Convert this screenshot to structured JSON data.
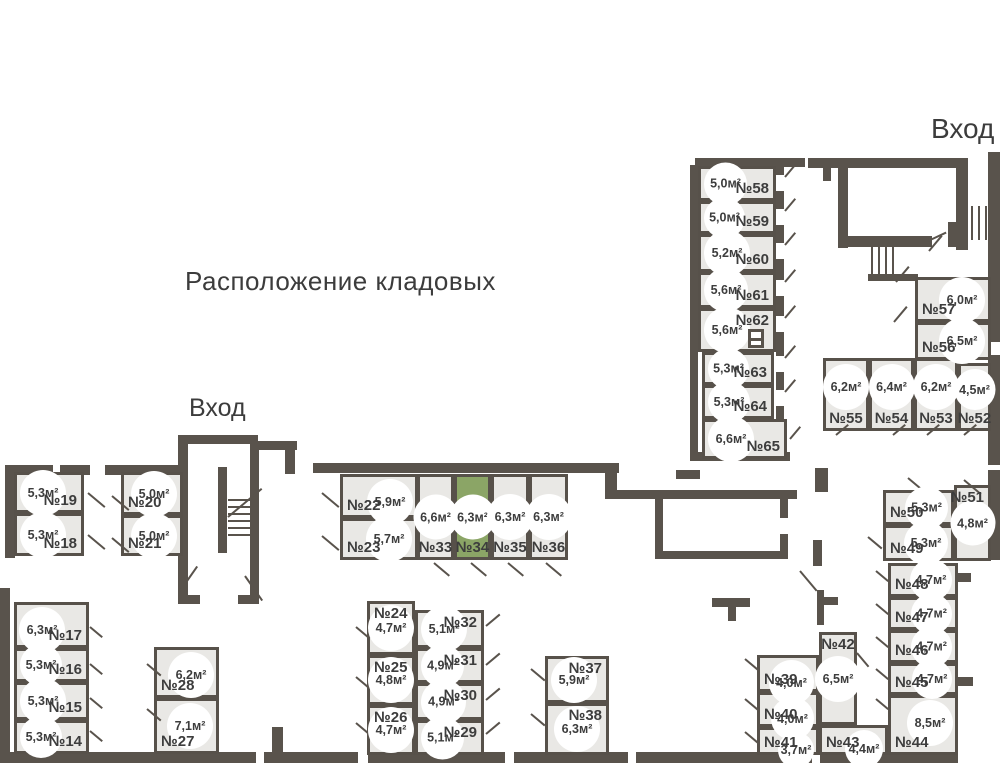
{
  "title": "Расположение кладовых",
  "entrances": {
    "top": {
      "label": "Вход"
    },
    "left": {
      "label": "Вход"
    }
  },
  "colors": {
    "wall": "#59534c",
    "room_fill": "#e9e8e5",
    "room_border": "#57514a",
    "highlight": "#8ba566",
    "text": "#3d3d3d",
    "white": "#ffffff"
  },
  "rooms": [
    {
      "n": "№19",
      "a": "5,3м²",
      "x": 14,
      "y": 472,
      "w": 70,
      "h": 41,
      "np": "br",
      "ap": "l"
    },
    {
      "n": "№18",
      "a": "5,3м²",
      "x": 14,
      "y": 513,
      "w": 70,
      "h": 43,
      "np": "br",
      "ap": "l"
    },
    {
      "n": "№20",
      "a": "5,0м²",
      "x": 121,
      "y": 472,
      "w": 62,
      "h": 43,
      "np": "bl",
      "ap": "r"
    },
    {
      "n": "№21",
      "a": "5,0м²",
      "x": 121,
      "y": 515,
      "w": 62,
      "h": 41,
      "np": "bl",
      "ap": "r"
    },
    {
      "n": "№22",
      "a": "5,9м²",
      "x": 340,
      "y": 474,
      "w": 78,
      "h": 44,
      "np": "bl",
      "ap": "tr"
    },
    {
      "n": "№23",
      "a": "5,7м²",
      "x": 340,
      "y": 518,
      "w": 78,
      "h": 42,
      "np": "bl",
      "ap": "r"
    },
    {
      "n": "№33",
      "a": "6,6м²",
      "x": 417,
      "y": 474,
      "w": 37,
      "h": 86,
      "np": "b",
      "ap": "c"
    },
    {
      "n": "№34",
      "a": "6,3м²",
      "x": 454,
      "y": 474,
      "w": 37,
      "h": 86,
      "np": "b",
      "ap": "c",
      "hl": true
    },
    {
      "n": "№35",
      "a": "6,3м²",
      "x": 491,
      "y": 474,
      "w": 38,
      "h": 86,
      "np": "b",
      "ap": "c"
    },
    {
      "n": "№36",
      "a": "6,3м²",
      "x": 529,
      "y": 474,
      "w": 39,
      "h": 86,
      "np": "b",
      "ap": "c"
    },
    {
      "n": "№17",
      "a": "6,3м²",
      "x": 14,
      "y": 602,
      "w": 75,
      "h": 46,
      "np": "br",
      "ap": "tl"
    },
    {
      "n": "№16",
      "a": "5,3м²",
      "x": 14,
      "y": 648,
      "w": 75,
      "h": 34,
      "np": "br",
      "ap": "l"
    },
    {
      "n": "№15",
      "a": "5,3м²",
      "x": 14,
      "y": 682,
      "w": 75,
      "h": 38,
      "np": "br",
      "ap": "l"
    },
    {
      "n": "№14",
      "a": "5,3м²",
      "x": 14,
      "y": 720,
      "w": 75,
      "h": 34,
      "np": "br",
      "ap": "l"
    },
    {
      "n": "№28",
      "a": "6,2м²",
      "x": 154,
      "y": 647,
      "w": 65,
      "h": 51,
      "np": "bl",
      "ap": "tr"
    },
    {
      "n": "№27",
      "a": "7,1м²",
      "x": 154,
      "y": 698,
      "w": 65,
      "h": 56,
      "np": "bl",
      "ap": "r"
    },
    {
      "n": "№24",
      "a": "4,7м²",
      "x": 367,
      "y": 601,
      "w": 48,
      "h": 54,
      "np": "tl",
      "ap": "c"
    },
    {
      "n": "№25",
      "a": "4,8м²",
      "x": 367,
      "y": 655,
      "w": 48,
      "h": 50,
      "np": "tl",
      "ap": "c"
    },
    {
      "n": "№26",
      "a": "4,7м²",
      "x": 367,
      "y": 705,
      "w": 48,
      "h": 50,
      "np": "tl",
      "ap": "c"
    },
    {
      "n": "№32",
      "a": "5,1м²",
      "x": 415,
      "y": 610,
      "w": 69,
      "h": 38,
      "np": "tr",
      "ap": "l"
    },
    {
      "n": "№31",
      "a": "4,9м²",
      "x": 415,
      "y": 648,
      "w": 69,
      "h": 35,
      "np": "tr",
      "ap": "l"
    },
    {
      "n": "№30",
      "a": "4,9м²",
      "x": 415,
      "y": 683,
      "w": 69,
      "h": 37,
      "np": "tr",
      "ap": "l"
    },
    {
      "n": "№29",
      "a": "5,1м²",
      "x": 415,
      "y": 720,
      "w": 69,
      "h": 35,
      "np": "tr",
      "ap": "l"
    },
    {
      "n": "№37",
      "a": "5,9м²",
      "x": 545,
      "y": 656,
      "w": 64,
      "h": 47,
      "np": "tr",
      "ap": "l"
    },
    {
      "n": "№38",
      "a": "6,3м²",
      "x": 545,
      "y": 703,
      "w": 64,
      "h": 52,
      "np": "tr",
      "ap": "c"
    },
    {
      "n": "№39",
      "a": "4,0м²",
      "x": 757,
      "y": 655,
      "w": 62,
      "h": 37,
      "np": "bl",
      "ap": "tr"
    },
    {
      "n": "№40",
      "a": "4,0м²",
      "x": 757,
      "y": 692,
      "w": 62,
      "h": 35,
      "np": "bl",
      "ap": "tr"
    },
    {
      "n": "№41",
      "a": "3,7м²",
      "x": 757,
      "y": 727,
      "w": 62,
      "h": 28,
      "np": "bl",
      "ap": "tr"
    },
    {
      "n": "№42",
      "a": "6,5м²",
      "x": 819,
      "y": 632,
      "w": 38,
      "h": 93,
      "np": "t",
      "ap": "c"
    },
    {
      "n": "№43",
      "a": "4,4м²",
      "x": 819,
      "y": 725,
      "w": 69,
      "h": 30,
      "np": "bl",
      "ap": "tr"
    },
    {
      "n": "№44",
      "a": "8,5м²",
      "x": 888,
      "y": 695,
      "w": 70,
      "h": 60,
      "np": "bl",
      "ap": "tr"
    },
    {
      "n": "№45",
      "a": "4,7м²",
      "x": 888,
      "y": 663,
      "w": 70,
      "h": 32,
      "np": "bl",
      "ap": "r"
    },
    {
      "n": "№46",
      "a": "4,7м²",
      "x": 888,
      "y": 630,
      "w": 70,
      "h": 33,
      "np": "bl",
      "ap": "r"
    },
    {
      "n": "№47",
      "a": "4,7м²",
      "x": 888,
      "y": 597,
      "w": 70,
      "h": 33,
      "np": "bl",
      "ap": "r"
    },
    {
      "n": "№48",
      "a": "4,7м²",
      "x": 888,
      "y": 563,
      "w": 70,
      "h": 34,
      "np": "bl",
      "ap": "r"
    },
    {
      "n": "№49",
      "a": "5,3м²",
      "x": 883,
      "y": 525,
      "w": 71,
      "h": 36,
      "np": "bl",
      "ap": "r"
    },
    {
      "n": "№50",
      "a": "5,3м²",
      "x": 883,
      "y": 490,
      "w": 71,
      "h": 35,
      "np": "bl",
      "ap": "r"
    },
    {
      "n": "№51",
      "a": "4,8м²",
      "x": 954,
      "y": 485,
      "w": 37,
      "h": 76,
      "np": "tr",
      "ap": "c"
    },
    {
      "n": "№55",
      "a": "6,2м²",
      "x": 823,
      "y": 358,
      "w": 46,
      "h": 73,
      "np": "b",
      "ap": "t"
    },
    {
      "n": "№54",
      "a": "6,4м²",
      "x": 869,
      "y": 358,
      "w": 45,
      "h": 73,
      "np": "b",
      "ap": "t"
    },
    {
      "n": "№53",
      "a": "6,2м²",
      "x": 914,
      "y": 358,
      "w": 44,
      "h": 73,
      "np": "b",
      "ap": "t"
    },
    {
      "n": "№52",
      "a": "4,5м²",
      "x": 958,
      "y": 363,
      "w": 33,
      "h": 68,
      "np": "b",
      "ap": "t"
    },
    {
      "n": "№57",
      "a": "6,0м²",
      "x": 915,
      "y": 277,
      "w": 76,
      "h": 45,
      "np": "bl",
      "ap": "r"
    },
    {
      "n": "№56",
      "a": "6,5м²",
      "x": 915,
      "y": 322,
      "w": 76,
      "h": 38,
      "np": "bl",
      "ap": "r"
    },
    {
      "n": "№58",
      "a": "5,0м²",
      "x": 698,
      "y": 166,
      "w": 78,
      "h": 35,
      "np": "br",
      "ap": "l"
    },
    {
      "n": "№59",
      "a": "5,0м²",
      "x": 698,
      "y": 201,
      "w": 78,
      "h": 33,
      "np": "br",
      "ap": "l"
    },
    {
      "n": "№60",
      "a": "5,2м²",
      "x": 698,
      "y": 234,
      "w": 78,
      "h": 38,
      "np": "br",
      "ap": "l"
    },
    {
      "n": "№61",
      "a": "5,6м²",
      "x": 698,
      "y": 272,
      "w": 78,
      "h": 36,
      "np": "br",
      "ap": "l"
    },
    {
      "n": "№62",
      "a": "5,6м²",
      "x": 698,
      "y": 308,
      "w": 78,
      "h": 44,
      "np": "tr",
      "ap": "l"
    },
    {
      "n": "№63",
      "a": "5,3м²",
      "x": 702,
      "y": 352,
      "w": 72,
      "h": 33,
      "np": "br",
      "ap": "l"
    },
    {
      "n": "№64",
      "a": "5,3м²",
      "x": 702,
      "y": 385,
      "w": 72,
      "h": 34,
      "np": "br",
      "ap": "l"
    },
    {
      "n": "№65",
      "a": "6,6м²",
      "x": 702,
      "y": 419,
      "w": 85,
      "h": 40,
      "np": "br",
      "ap": "l"
    }
  ],
  "walls": [
    [
      695,
      158,
      110,
      9
    ],
    [
      808,
      158,
      160,
      10
    ],
    [
      988,
      152,
      12,
      190
    ],
    [
      690,
      165,
      8,
      296
    ],
    [
      776,
      165,
      8,
      292
    ],
    [
      776,
      175,
      8,
      16,
      "#ffffff"
    ],
    [
      776,
      209,
      8,
      16,
      "#ffffff"
    ],
    [
      776,
      243,
      8,
      16,
      "#ffffff"
    ],
    [
      776,
      280,
      8,
      16,
      "#ffffff"
    ],
    [
      776,
      316,
      8,
      16,
      "#ffffff"
    ],
    [
      776,
      356,
      8,
      16,
      "#ffffff"
    ],
    [
      776,
      390,
      8,
      16,
      "#ffffff"
    ],
    [
      823,
      167,
      8,
      14
    ],
    [
      838,
      168,
      10,
      80
    ],
    [
      956,
      168,
      12,
      82
    ],
    [
      838,
      236,
      94,
      11
    ],
    [
      948,
      222,
      10,
      25
    ],
    [
      868,
      274,
      50,
      7
    ],
    [
      988,
      355,
      12,
      110
    ],
    [
      988,
      470,
      12,
      90
    ],
    [
      698,
      452,
      92,
      9
    ],
    [
      676,
      470,
      24,
      9
    ],
    [
      605,
      463,
      12,
      35
    ],
    [
      573,
      463,
      46,
      10
    ],
    [
      313,
      463,
      262,
      10
    ],
    [
      105,
      465,
      80,
      10
    ],
    [
      5,
      465,
      48,
      10
    ],
    [
      60,
      465,
      30,
      10
    ],
    [
      5,
      470,
      10,
      88
    ],
    [
      178,
      435,
      80,
      9
    ],
    [
      178,
      443,
      10,
      160
    ],
    [
      250,
      443,
      9,
      160
    ],
    [
      257,
      441,
      40,
      9
    ],
    [
      285,
      450,
      10,
      24
    ],
    [
      218,
      467,
      9,
      86
    ],
    [
      178,
      595,
      22,
      9
    ],
    [
      238,
      595,
      21,
      9
    ],
    [
      605,
      490,
      192,
      9
    ],
    [
      655,
      497,
      8,
      62
    ],
    [
      655,
      551,
      132,
      8
    ],
    [
      780,
      492,
      8,
      26
    ],
    [
      780,
      534,
      8,
      25
    ],
    [
      815,
      468,
      13,
      24
    ],
    [
      813,
      540,
      9,
      26
    ],
    [
      817,
      590,
      7,
      35
    ],
    [
      822,
      597,
      16,
      8
    ],
    [
      712,
      598,
      38,
      9
    ],
    [
      728,
      607,
      8,
      14
    ],
    [
      0,
      588,
      10,
      175
    ],
    [
      272,
      727,
      11,
      26
    ],
    [
      954,
      573,
      17,
      9
    ],
    [
      954,
      677,
      19,
      9
    ],
    [
      5,
      752,
      953,
      11
    ],
    [
      256,
      752,
      8,
      11,
      "#ffffff"
    ],
    [
      358,
      752,
      10,
      11,
      "#ffffff"
    ],
    [
      505,
      752,
      9,
      11,
      "#ffffff"
    ],
    [
      628,
      752,
      8,
      11,
      "#ffffff"
    ],
    [
      812,
      752,
      8,
      11,
      "#ffffff"
    ]
  ],
  "stairs": [
    [
      964,
      206,
      24,
      34,
      "v"
    ],
    [
      871,
      243,
      27,
      33,
      "v"
    ],
    [
      228,
      499,
      22,
      40,
      "h"
    ]
  ],
  "doors": [
    [
      88,
      492,
      22,
      40
    ],
    [
      112,
      495,
      22,
      40
    ],
    [
      88,
      534,
      22,
      40
    ],
    [
      112,
      537,
      22,
      40
    ],
    [
      322,
      492,
      22,
      40
    ],
    [
      322,
      535,
      22,
      40
    ],
    [
      434,
      562,
      20,
      40
    ],
    [
      471,
      562,
      20,
      40
    ],
    [
      508,
      562,
      20,
      40
    ],
    [
      546,
      562,
      20,
      40
    ],
    [
      180,
      590,
      30,
      -55
    ],
    [
      245,
      575,
      30,
      55
    ],
    [
      90,
      626,
      16,
      40
    ],
    [
      90,
      663,
      16,
      40
    ],
    [
      90,
      697,
      16,
      40
    ],
    [
      90,
      730,
      16,
      40
    ],
    [
      147,
      663,
      18,
      40
    ],
    [
      147,
      708,
      18,
      40
    ],
    [
      356,
      626,
      18,
      40
    ],
    [
      356,
      676,
      18,
      40
    ],
    [
      356,
      722,
      18,
      40
    ],
    [
      486,
      625,
      18,
      -40
    ],
    [
      486,
      664,
      18,
      -40
    ],
    [
      486,
      699,
      18,
      -40
    ],
    [
      486,
      733,
      18,
      -40
    ],
    [
      531,
      668,
      18,
      40
    ],
    [
      531,
      713,
      18,
      40
    ],
    [
      745,
      658,
      18,
      40
    ],
    [
      745,
      698,
      18,
      40
    ],
    [
      745,
      731,
      18,
      40
    ],
    [
      857,
      652,
      18,
      50
    ],
    [
      800,
      570,
      26,
      50
    ],
    [
      876,
      570,
      16,
      40
    ],
    [
      876,
      603,
      16,
      40
    ],
    [
      876,
      636,
      16,
      40
    ],
    [
      876,
      668,
      16,
      40
    ],
    [
      876,
      698,
      16,
      40
    ],
    [
      868,
      536,
      18,
      40
    ],
    [
      908,
      477,
      22,
      40
    ],
    [
      964,
      479,
      22,
      40
    ],
    [
      836,
      434,
      16,
      -40
    ],
    [
      893,
      434,
      16,
      -40
    ],
    [
      927,
      434,
      16,
      -40
    ],
    [
      964,
      434,
      16,
      -40
    ],
    [
      896,
      281,
      20,
      -50
    ],
    [
      894,
      321,
      20,
      -50
    ],
    [
      929,
      250,
      20,
      -50
    ],
    [
      785,
      176,
      16,
      -50
    ],
    [
      785,
      210,
      16,
      -50
    ],
    [
      785,
      244,
      16,
      -50
    ],
    [
      785,
      281,
      16,
      -50
    ],
    [
      785,
      317,
      16,
      -50
    ],
    [
      785,
      357,
      16,
      -50
    ],
    [
      785,
      391,
      16,
      -50
    ],
    [
      790,
      438,
      16,
      -50
    ],
    [
      928,
      240,
      20,
      -25
    ],
    [
      228,
      516,
      44,
      -40
    ]
  ],
  "symbol62": {
    "x": 748,
    "y": 329,
    "w": 16,
    "h": 19
  }
}
